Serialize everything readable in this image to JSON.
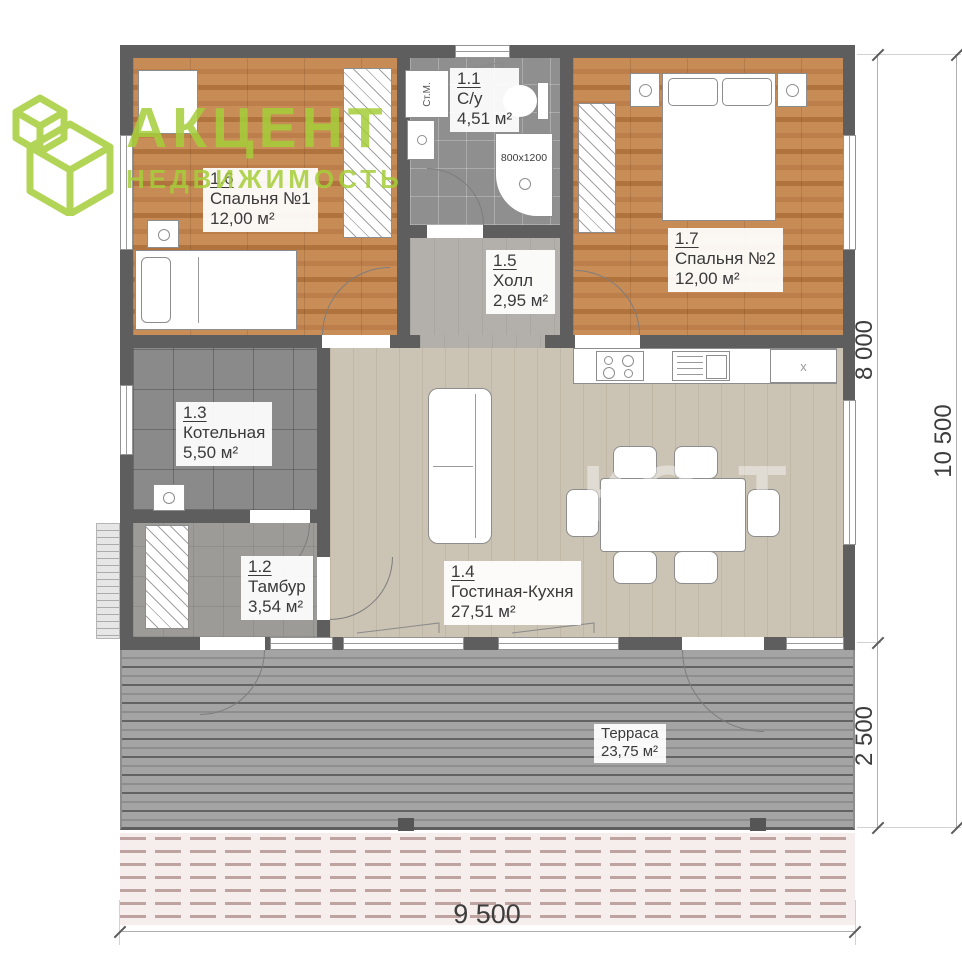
{
  "logo": {
    "title": "АКЦЕНТ",
    "subtitle": "НЕДВИЖИМОСТЬ"
  },
  "rooms": {
    "bathroom": {
      "id": "1.1",
      "name": "С/у",
      "area": "4,51 м²"
    },
    "tambour": {
      "id": "1.2",
      "name": "Тамбур",
      "area": "3,54 м²"
    },
    "boiler": {
      "id": "1.3",
      "name": "Котельная",
      "area": "5,50 м²"
    },
    "living": {
      "id": "1.4",
      "name": "Гостиная-Кухня",
      "area": "27,51 м²"
    },
    "hall": {
      "id": "1.5",
      "name": "Холл",
      "area": "2,95 м²"
    },
    "bedroom1": {
      "id": "1.6",
      "name": "Спальня №1",
      "area": "12,00 м²"
    },
    "bedroom2": {
      "id": "1.7",
      "name": "Спальня №2",
      "area": "12,00 м²"
    },
    "terrace": {
      "name": "Терраса",
      "area": "23,75 м²"
    }
  },
  "fixtures": {
    "shower_size": "800х1200",
    "washing_machine": "Ст.М.",
    "fridge_mark": "x"
  },
  "dimensions": {
    "bottom_width": "9 500",
    "right_main": "8 000",
    "right_terrace": "2 500",
    "right_total": "10 500"
  },
  "watermark": {
    "text": "КО-Т"
  },
  "colors": {
    "logo_green": "#a6ce3a",
    "wall": "#5e5e5e",
    "wood": "#c08150",
    "living_floor": "#cbc3b3"
  }
}
